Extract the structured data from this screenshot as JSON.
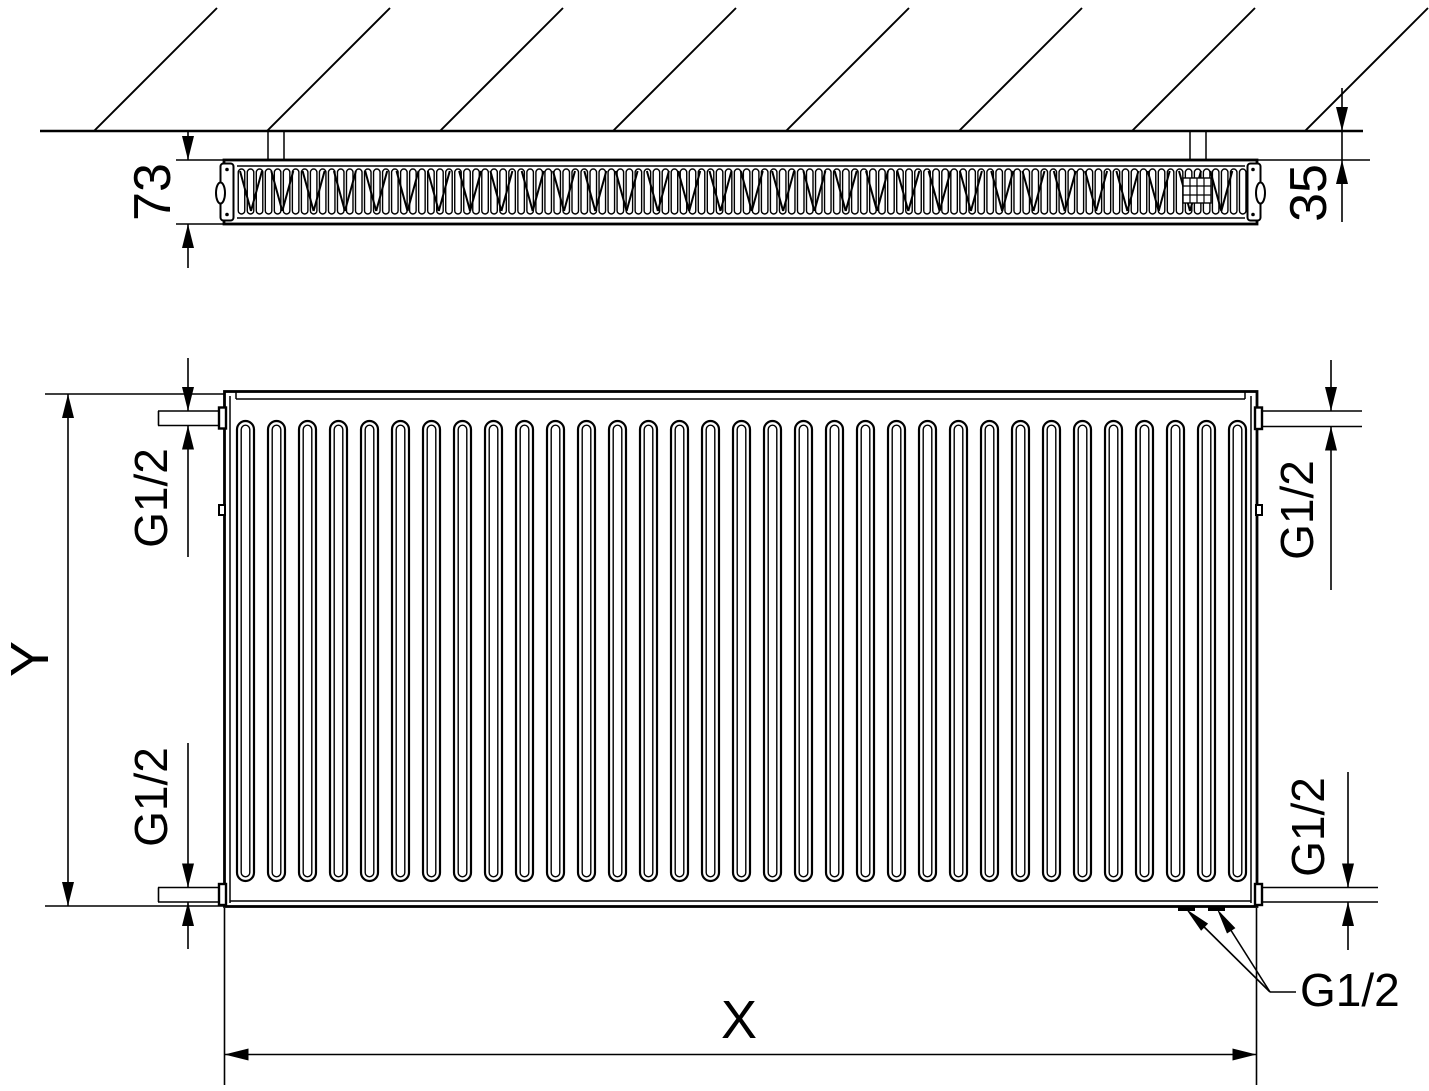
{
  "labels": {
    "depth_mm": "73",
    "wall_clearance_mm": "35",
    "height": "Y",
    "length": "X",
    "thread_top_left": "G1/2",
    "thread_bottom_left": "G1/2",
    "thread_top_right": "G1/2",
    "thread_bottom_right": "G1/2",
    "thread_bottom_callout": "G1/2"
  },
  "colors": {
    "line": "#000000",
    "background": "#ffffff"
  },
  "geometry": {
    "hatch": {
      "count": 8,
      "first_x": 94,
      "spacing": 173,
      "wall_y": 131,
      "top_y": 8,
      "rise": 123
    },
    "top_view_loops": {
      "count": 112,
      "first_center_x": 241.5,
      "pitch": 9.02,
      "top": 169,
      "bottom": 214,
      "width": 6.5
    },
    "top_view_vs": {
      "count": 32,
      "first_x": 240,
      "pitch": 31.3,
      "top": 171,
      "bottom": 211,
      "half": 11
    },
    "front_fins": {
      "count": 33,
      "first_x": 237,
      "pitch": 31,
      "width": 17,
      "top": 421,
      "bottom": 881,
      "inner_inset": 4.2
    }
  }
}
